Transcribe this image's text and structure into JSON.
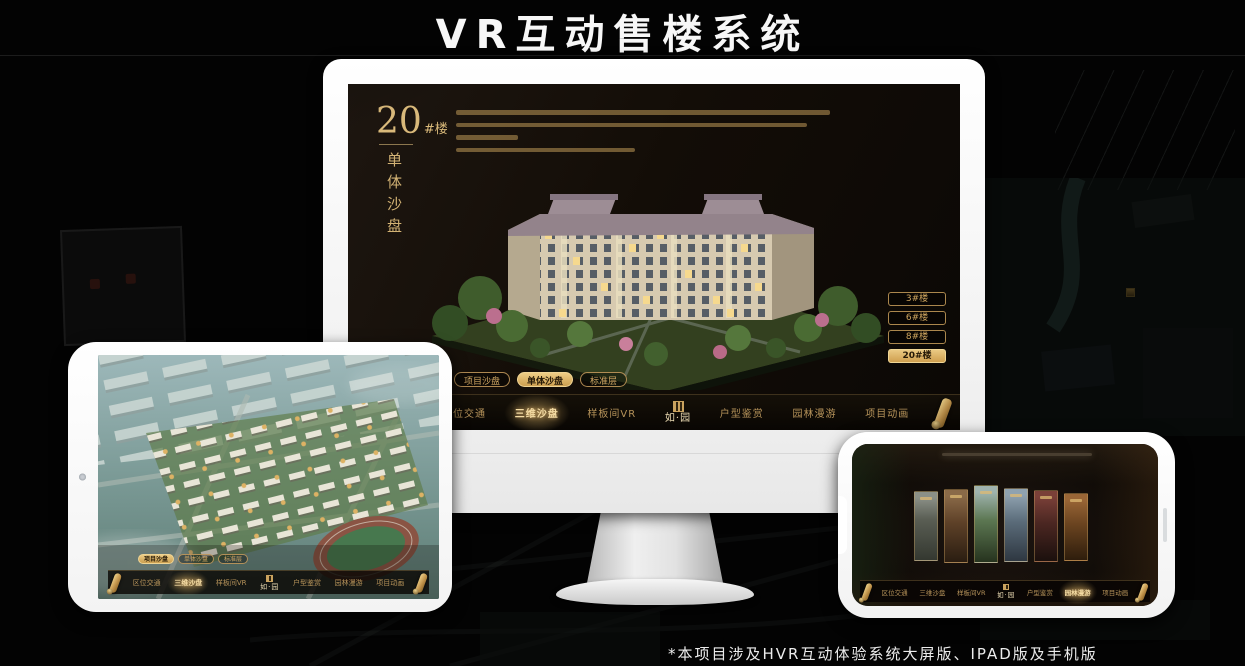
{
  "page": {
    "title": "VR互动售楼系统",
    "footnote": "*本项目涉及HVR互动体验系统大屏版、IPAD版及手机版"
  },
  "colors": {
    "gold": "#c99e5f",
    "gold_bright": "#e8c87e",
    "gold_fill": "#d8b267",
    "screen_bg": "#17110a",
    "frame_white": "#ffffff"
  },
  "brand": {
    "logo_text": "如·园",
    "seal_icon": "seal-icon"
  },
  "nav": {
    "items": [
      "区位交通",
      "三维沙盘",
      "样板间VR",
      "户型鉴赏",
      "园林漫游",
      "项目动画"
    ]
  },
  "subtabs": {
    "items": [
      "项目沙盘",
      "单体沙盘",
      "标准层"
    ]
  },
  "monitor_screen": {
    "block_number": "20",
    "block_suffix": "#楼",
    "block_subtitle": "单体沙盘",
    "floor_buttons": [
      "3#楼",
      "6#楼",
      "8#楼",
      "20#楼"
    ],
    "active_floor": "20#楼",
    "active_subtab": "单体沙盘",
    "active_nav": "三维沙盘"
  },
  "ipad_screen": {
    "active_subtab": "项目沙盘",
    "active_nav": "三维沙盘"
  },
  "phone_screen": {
    "active_nav": "园林漫游",
    "gallery_panel_count": 6
  },
  "icons": {
    "scroll": "scroll-icon",
    "seal": "seal-icon",
    "camera": "camera-icon"
  }
}
